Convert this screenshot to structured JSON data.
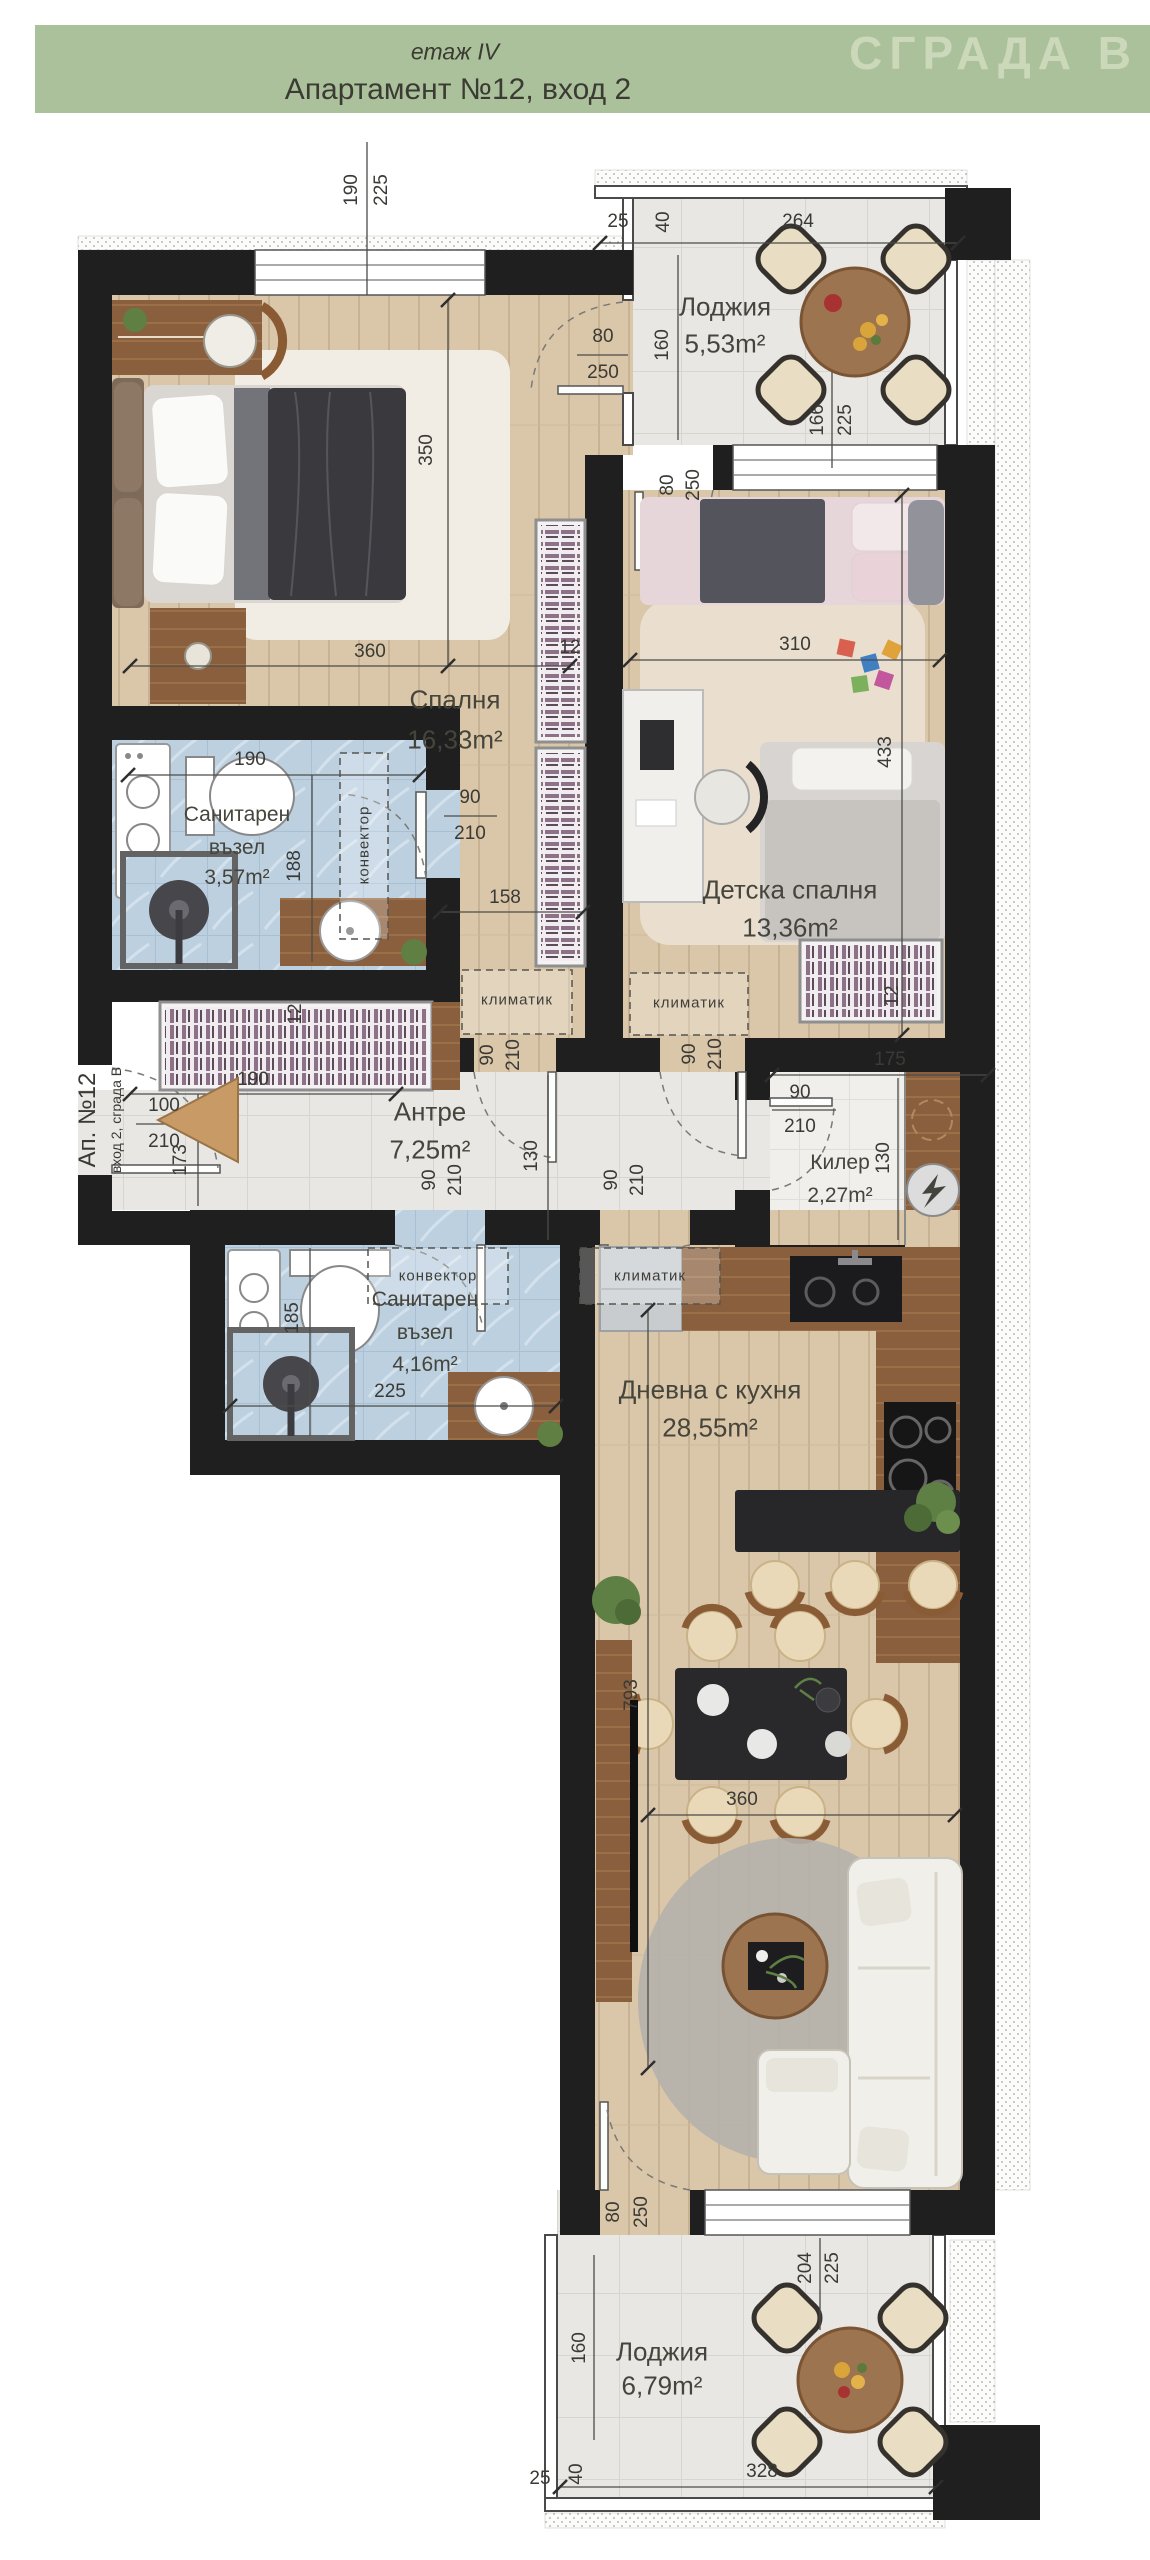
{
  "header": {
    "floor": "етаж IV",
    "title": "Апартамент №12, вход 2",
    "brand": "СГРАДА В"
  },
  "side_label": {
    "apartment": "Ап. №12",
    "entrance": "вход 2, сграда В"
  },
  "rooms": {
    "loggia_top": {
      "name": "Лоджия",
      "area": "5,53m²"
    },
    "bedroom": {
      "name": "Спалня",
      "area": "16,33m²"
    },
    "bathroom_1": {
      "name": "Санитарен",
      "name2": "възел",
      "area": "3,57m²"
    },
    "kids_bedroom": {
      "name": "Детска спалня",
      "area": "13,36m²"
    },
    "hallway": {
      "name": "Антре",
      "area": "7,25m²"
    },
    "pantry": {
      "name": "Килер",
      "area": "2,27m²"
    },
    "bathroom_2": {
      "name": "Санитарен",
      "name2": "възел",
      "area": "4,16m²"
    },
    "living": {
      "name": "Дневна с кухня",
      "area": "28,55m²"
    },
    "loggia_bottom": {
      "name": "Лоджия",
      "area": "6,79m²"
    }
  },
  "annotations": {
    "ac": "климатик",
    "convector": "конвектор"
  },
  "dims": {
    "d12": "12",
    "d25": "25",
    "d40": "40",
    "d80": "80",
    "d90": "90",
    "d100": "100",
    "d130": "130",
    "d158": "158",
    "d160": "160",
    "d166": "166",
    "d173": "173",
    "d175": "175",
    "d185": "185",
    "d188": "188",
    "d190": "190",
    "d204": "204",
    "d210": "210",
    "d225": "225",
    "d250": "250",
    "d264": "264",
    "d310": "310",
    "d328": "328",
    "d350": "350",
    "d360": "360",
    "d433": "433",
    "d793": "793"
  },
  "colors": {
    "header_green": "#abc19b",
    "brand_text": "#ccd8ba",
    "wall_black": "#1f1f1f",
    "wood_floor": "#dac6a8",
    "dark_wood": "#8a5f3e",
    "grey_tile": "#e9e7e4",
    "blue_tile": "#bdd0e0",
    "entrance_arrow": "#c79a66"
  }
}
